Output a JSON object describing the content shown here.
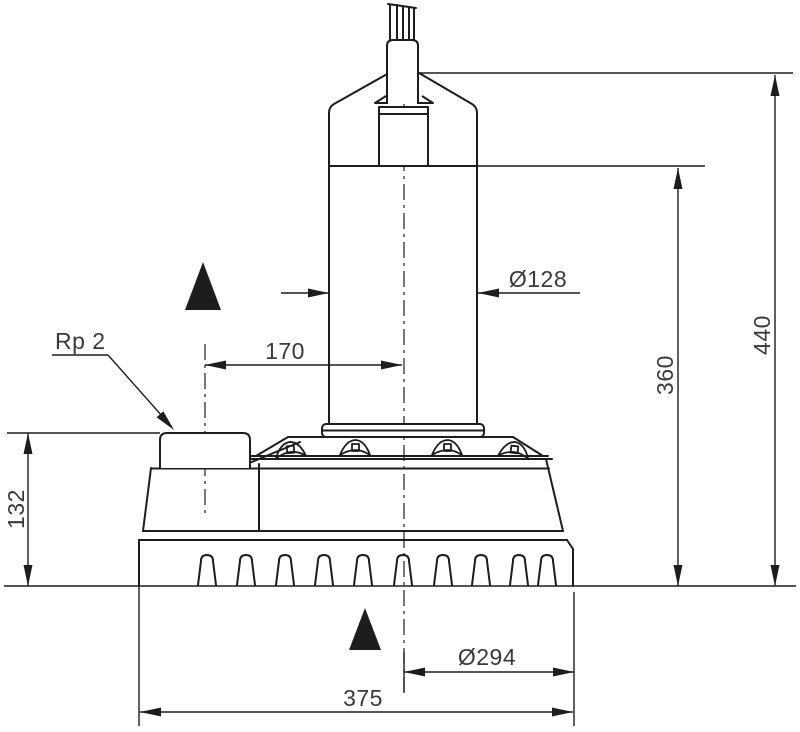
{
  "drawing": {
    "type": "technical-dimension-drawing",
    "subject": "submersible drain pump, side view with dimensions",
    "background": "#ffffff",
    "line_color": "#1d1d1b",
    "text_color": "#3a3a38"
  },
  "labels": {
    "connection_thread": "Rp 2",
    "dim_port_height": "132",
    "dim_port_offset": "170",
    "dim_motor_diameter": "Ø128",
    "dim_height_to_motor_top": "360",
    "dim_total_height": "440",
    "dim_base_diameter": "Ø294",
    "dim_overall_width": "375"
  },
  "symbols": {
    "upper_marker": "min-water-level-triangle",
    "lower_marker": "min-water-level-triangle"
  }
}
